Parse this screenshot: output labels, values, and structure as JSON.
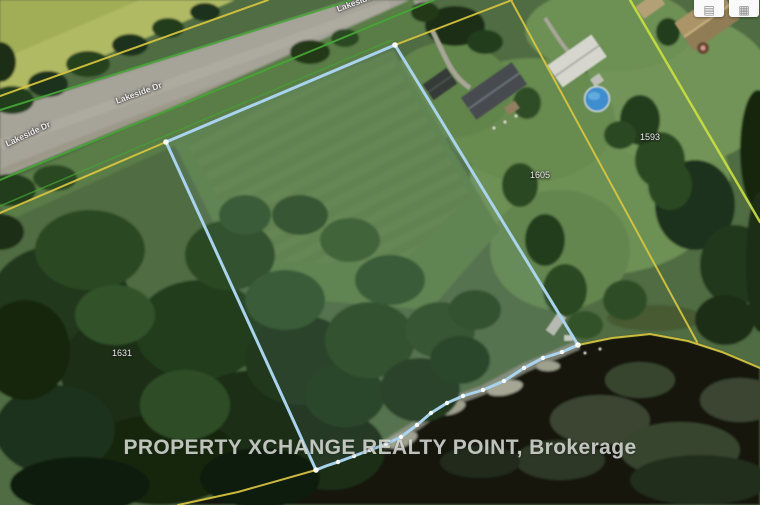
{
  "map": {
    "road_labels": [
      "Lakeside Dr",
      "Lakeside Dr",
      "Lakeside Dr"
    ],
    "parcel_numbers": [
      "1631",
      "1605",
      "1593"
    ],
    "watermark": "PROPERTY XCHANGE REALTY POINT, Brokerage",
    "colors": {
      "boundary_blue": "#a9d3ef",
      "vertex_white": "#ffffff",
      "parcel_line_yellow": "#d9c63f",
      "parcel_line_bright": "#c9e03b",
      "road_edge_green": "#46a636",
      "pool_blue": "#3e8ecf"
    },
    "controls": {
      "button1_glyph": "▤",
      "button2_glyph": "▦"
    }
  }
}
